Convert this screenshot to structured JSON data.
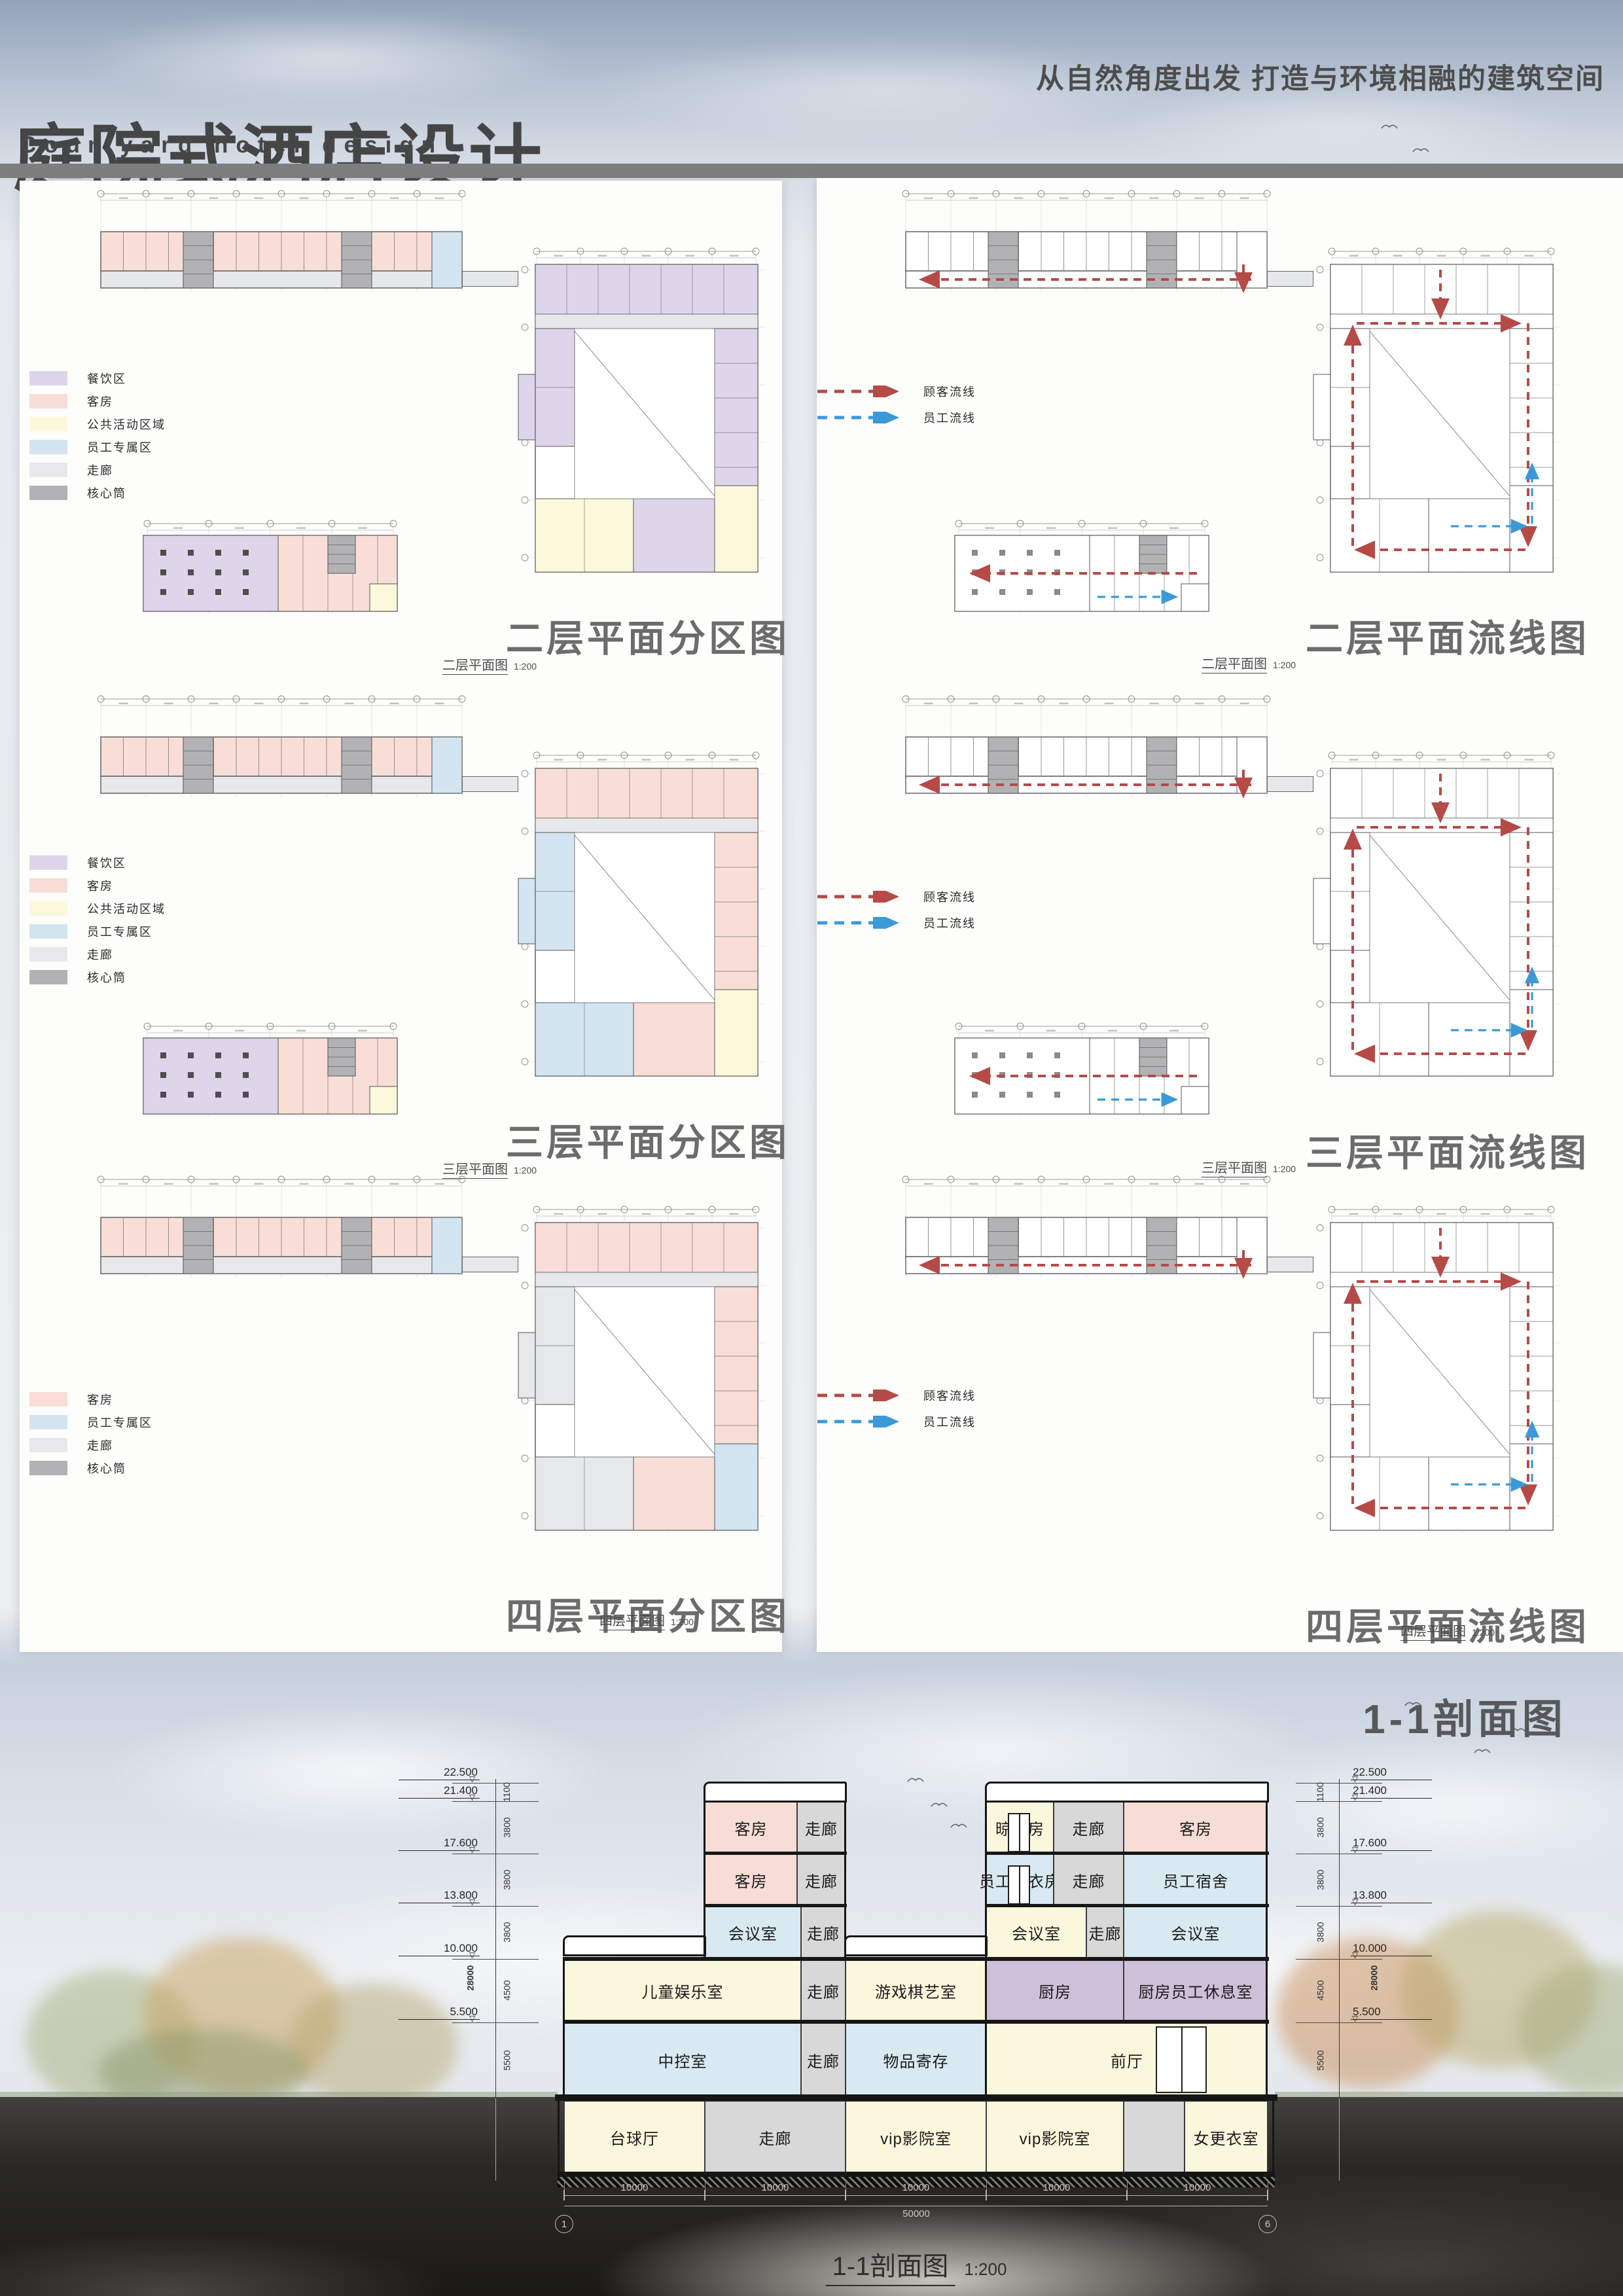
{
  "header": {
    "title": "庭院式酒店设计",
    "subtitle": "Courtyard hotel design",
    "tagline": "从自然角度出发 打造与环境相融的建筑空间"
  },
  "palette": {
    "pink": "#f7ddd6",
    "gray": "#d8d8d8",
    "yellow": "#fbf7dd",
    "blue": "#d9e9f1",
    "purple": "#cfc0d9",
    "core": "#b2b2b4",
    "corridor": "#e6e8ea",
    "dining_purple": "#ded5eb",
    "public_yellow": "#fbf8dc",
    "staff_blue": "#d3e5f0",
    "flow_red": "#b54a47",
    "flow_blue": "#3b99d8"
  },
  "legend_full": [
    {
      "label": "餐饮区",
      "color": "#ded5eb"
    },
    {
      "label": "客房",
      "color": "#f8ded7"
    },
    {
      "label": "公共活动区域",
      "color": "#fbf8dc"
    },
    {
      "label": "员工专属区",
      "color": "#d3e5f0"
    },
    {
      "label": "走廊",
      "color": "#e6e8ea"
    },
    {
      "label": "核心筒",
      "color": "#b2b2b4"
    }
  ],
  "legend_partial": [
    {
      "label": "客房",
      "color": "#f8ded7"
    },
    {
      "label": "员工专属区",
      "color": "#d3e5f0"
    },
    {
      "label": "走廊",
      "color": "#e6e8ea"
    },
    {
      "label": "核心筒",
      "color": "#b2b2b4"
    }
  ],
  "flow_legend": [
    {
      "label": "顾客流线",
      "color": "#b54a47"
    },
    {
      "label": "员工流线",
      "color": "#3b99d8"
    }
  ],
  "plan_scale": "1:200",
  "rows": [
    {
      "zone_title": "二层平面分区图",
      "flow_title": "二层平面流线图",
      "caption": "二层平面图"
    },
    {
      "zone_title": "三层平面分区图",
      "flow_title": "三层平面流线图",
      "caption": "三层平面图"
    },
    {
      "zone_title": "四层平面分区图",
      "flow_title": "四层平面流线图",
      "caption": "四层平面图"
    }
  ],
  "section": {
    "title": "1-1剖面图",
    "caption": "1-1剖面图",
    "scale": "1:200",
    "levels": [
      "22.500",
      "21.400",
      "17.600",
      "13.800",
      "10.000",
      "5.500"
    ],
    "segments": [
      "1100",
      "3800",
      "3800",
      "3800",
      "4500",
      "5500"
    ],
    "total_height": "28000",
    "span_labels": [
      "10000",
      "10000",
      "10000",
      "10000",
      "10000"
    ],
    "total_span": "50000",
    "axis_start": "1",
    "axis_end": "6",
    "floors": {
      "f5": [
        {
          "label": "客房",
          "color": "pink"
        },
        {
          "label": "走廊",
          "color": "gray"
        },
        {
          "label": "晾衣房",
          "color": "yellow"
        },
        {
          "label": "走廊",
          "color": "gray"
        },
        {
          "label": "客房",
          "color": "pink"
        }
      ],
      "f4": [
        {
          "label": "客房",
          "color": "pink"
        },
        {
          "label": "走廊",
          "color": "gray"
        },
        {
          "label": "员工晾衣房",
          "color": "blue"
        },
        {
          "label": "走廊",
          "color": "gray"
        },
        {
          "label": "员工宿舍",
          "color": "blue"
        }
      ],
      "f3": [
        {
          "label": "会议室",
          "color": "blue"
        },
        {
          "label": "走廊",
          "color": "gray"
        },
        {
          "label": "会议室",
          "color": "yellow"
        },
        {
          "label": "走廊",
          "color": "gray"
        },
        {
          "label": "会议室",
          "color": "blue"
        }
      ],
      "f2": [
        {
          "label": "儿童娱乐室",
          "color": "yellow"
        },
        {
          "label": "走廊",
          "color": "gray"
        },
        {
          "label": "游戏棋艺室",
          "color": "yellow"
        },
        {
          "label": "厨房",
          "color": "purple"
        },
        {
          "label": "厨房员工休息室",
          "color": "purple"
        }
      ],
      "f1": [
        {
          "label": "中控室",
          "color": "blue"
        },
        {
          "label": "走廊",
          "color": "gray"
        },
        {
          "label": "物品寄存",
          "color": "blue"
        },
        {
          "label": "前厅",
          "color": "yellow"
        }
      ],
      "b1": [
        {
          "label": "台球厅",
          "color": "yellow"
        },
        {
          "label": "走廊",
          "color": "gray"
        },
        {
          "label": "vip影院室",
          "color": "yellow"
        },
        {
          "label": "vip影院室",
          "color": "yellow"
        },
        {
          "label": "",
          "color": "gray"
        },
        {
          "label": "女更衣室",
          "color": "yellow"
        }
      ]
    }
  }
}
